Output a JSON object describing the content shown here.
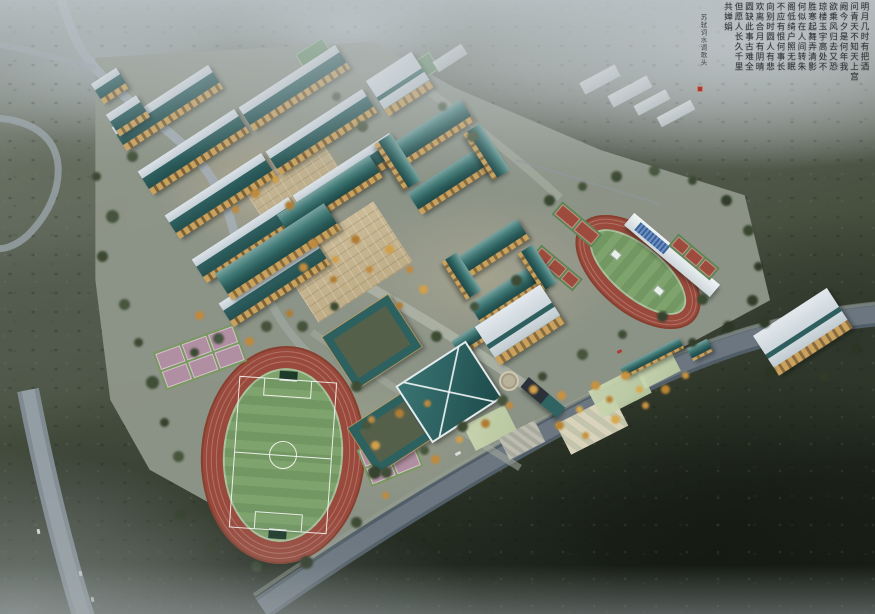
{
  "calligraphy": {
    "poem_columns": "明月几时有把酒\n问青天不知天上宫\n阙今夕是何年我\n欲乘风归去又恐\n琼楼玉宇高处不\n胜寒起舞弄清影\n何似在人间转朱\n阁低绮户照无眠\n不应有恨何事长\n向别时圆人有悲\n欢离合月有阴晴\n圆缺此事古难全\n但愿人长久千里\n共婵娟",
    "signature": "苏轼词水调歌头",
    "ink_color": "#23262b",
    "seal_color": "#a93a2c"
  },
  "palette": {
    "haze": "#bcc3c7",
    "forest_light": "#5c6456",
    "forest_dark": "#1c221b",
    "roof_teal": "#2e6362",
    "roof_light": "#ccd6dc",
    "facade_tan": "#c59f5c",
    "track_red": "#9a4a3c",
    "field_green": "#79a068",
    "court_pink": "#b18fa2",
    "court_red": "#9d4b3d",
    "road_grey": "#6b7680",
    "plaza_tan": "#c6b896",
    "tree_green": "#47563c",
    "tree_autumn": "#c08a3e",
    "grandstand_seats": "#39619c"
  }
}
